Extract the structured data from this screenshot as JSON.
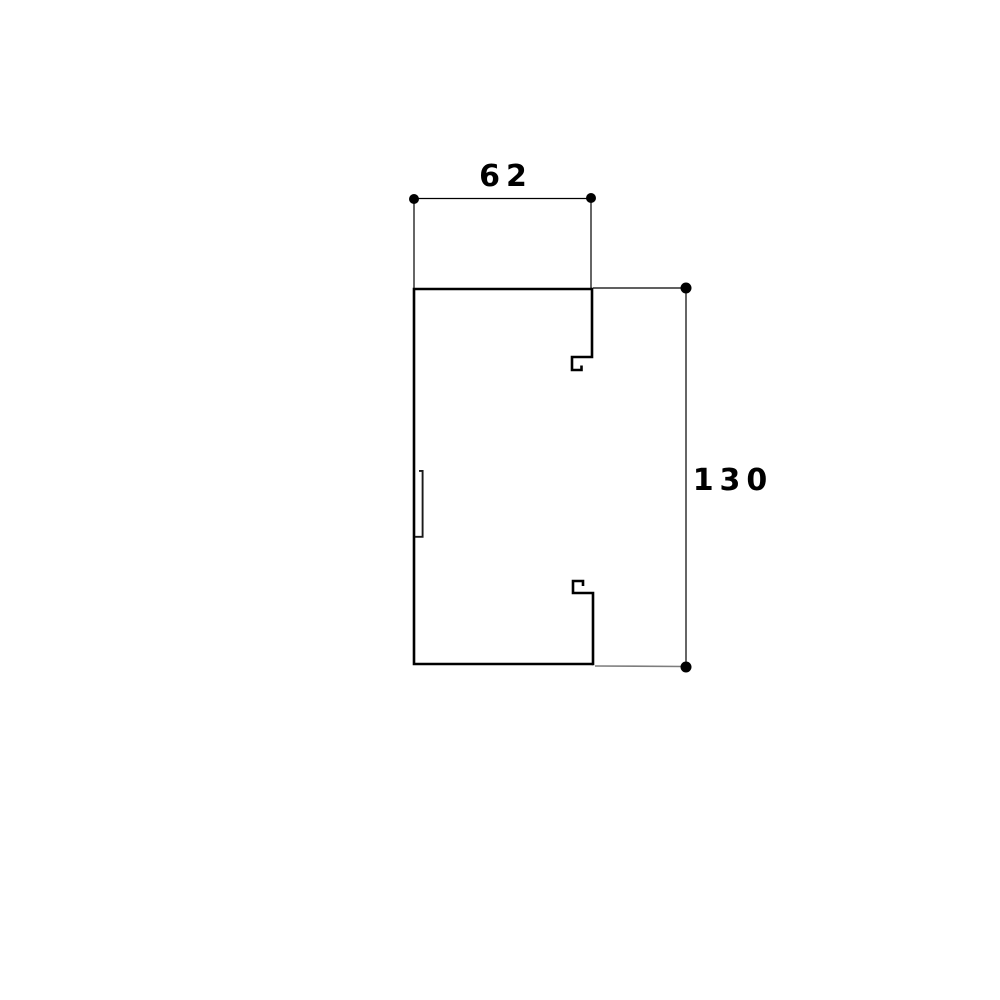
{
  "diagram": {
    "type": "technical-profile-drawing",
    "background_color": "#ffffff",
    "profile_line_color": "#000000",
    "dimension_line_color": "#000000",
    "extension_line_muted_color": "#7d7d7d",
    "dimensions": {
      "width": {
        "label": "62"
      },
      "height": {
        "label": "130"
      }
    }
  }
}
